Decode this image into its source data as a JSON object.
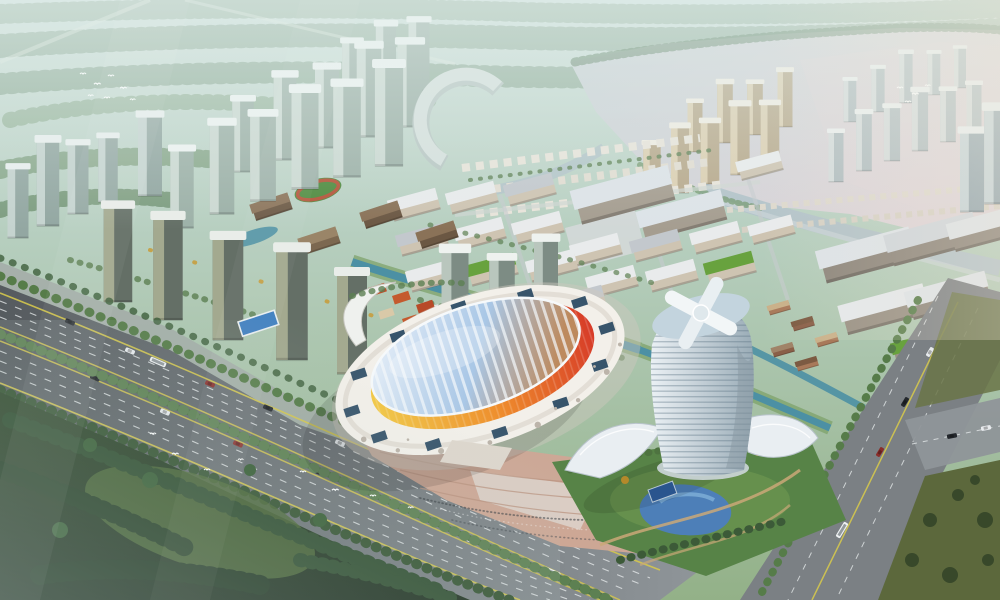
{
  "meta": {
    "description": "Oblique aerial dusk rendering of a mixed-use masterplan: clusters of glass residential towers, a low-rise office campus grid with canals, an oval arena with a ribbed glass roof and yellow-orange-red facade, a cylindrical landmark tower with a pinwheel crown, a wide tree-lined boulevard with traffic, a lake with winding river, green fields, dark forest and flocks of white birds",
    "style": "architectural-visualization",
    "view": "aerial-oblique"
  },
  "palette": {
    "sky_top": "#cfe0dc",
    "sky_mid": "#b7cfc0",
    "sky_low": "#93b188",
    "lake1": "#c9d2d6",
    "lake2": "#ddd4d8",
    "river": "#b3c3c9",
    "forest1": "#2e4629",
    "forest2": "#1b2c1c",
    "grass_patch": "#4a6634",
    "olive_field": "#5c683c",
    "road_dark": "#565b5f",
    "road_mid": "#747a7e",
    "road_light": "#8f9599",
    "lane_yellow": "#d4c64e",
    "lane_white": "#e3e7e9",
    "tree": "#5d8052",
    "tree_dark": "#33512f",
    "tree_autumn": "#c9992f",
    "canal": "#4c90a4",
    "pond": "#4d7fb8",
    "campus_wall": "#cec4b2",
    "campus_roof": "#e9ebec",
    "green_roof": "#68a23e",
    "arena_white": "#f3f0ea",
    "arena_yellow": "#f3c843",
    "arena_orange": "#ef8e2c",
    "arena_red": "#d73b28",
    "roof_glass_1": "#eef4fb",
    "roof_glass_2": "#a9c7e6",
    "roof_glass_3": "#bd8a5e",
    "skylight": "#2e4d66",
    "tower_light": "#eaf0f4",
    "tower_shade": "#9aacb7",
    "plaza": "#cda795",
    "haze": "#e3efec"
  },
  "scene": {
    "sky": {
      "label": "hazy green-blue sky and misty fields"
    },
    "lake": {
      "label": "lake with pink dusk reflection"
    },
    "river": {
      "label": "winding river"
    },
    "forest": {
      "label": "dark forest foreground"
    },
    "boulevard": {
      "label": "tree-lined boulevard",
      "lanes_per_direction": 4,
      "median": "tree rows"
    },
    "cross_road": {
      "label": "arterial cross road with intersection"
    },
    "arena": {
      "label": "oval arena",
      "roof": "ribbed glass",
      "facade": "yellow-orange-red gradient",
      "ring": "white podium with dark skylights and perforation dots"
    },
    "landmark_tower": {
      "label": "cylindrical tower with white pinwheel crown and curved glass podium"
    },
    "residential": {
      "label": "high-rise residential clusters with white roof caps"
    },
    "campus": {
      "label": "low-rise office campus grid with canals and green roofs"
    },
    "villas": {
      "label": "rows of white low-rise villas"
    },
    "park": {
      "label": "landscaped park with blue pond and court"
    },
    "plaza": {
      "label": "radial paved plaza with crowds"
    },
    "birds": {
      "flocks": 3
    },
    "vehicles": {
      "cars": 17,
      "buses": 5
    }
  }
}
